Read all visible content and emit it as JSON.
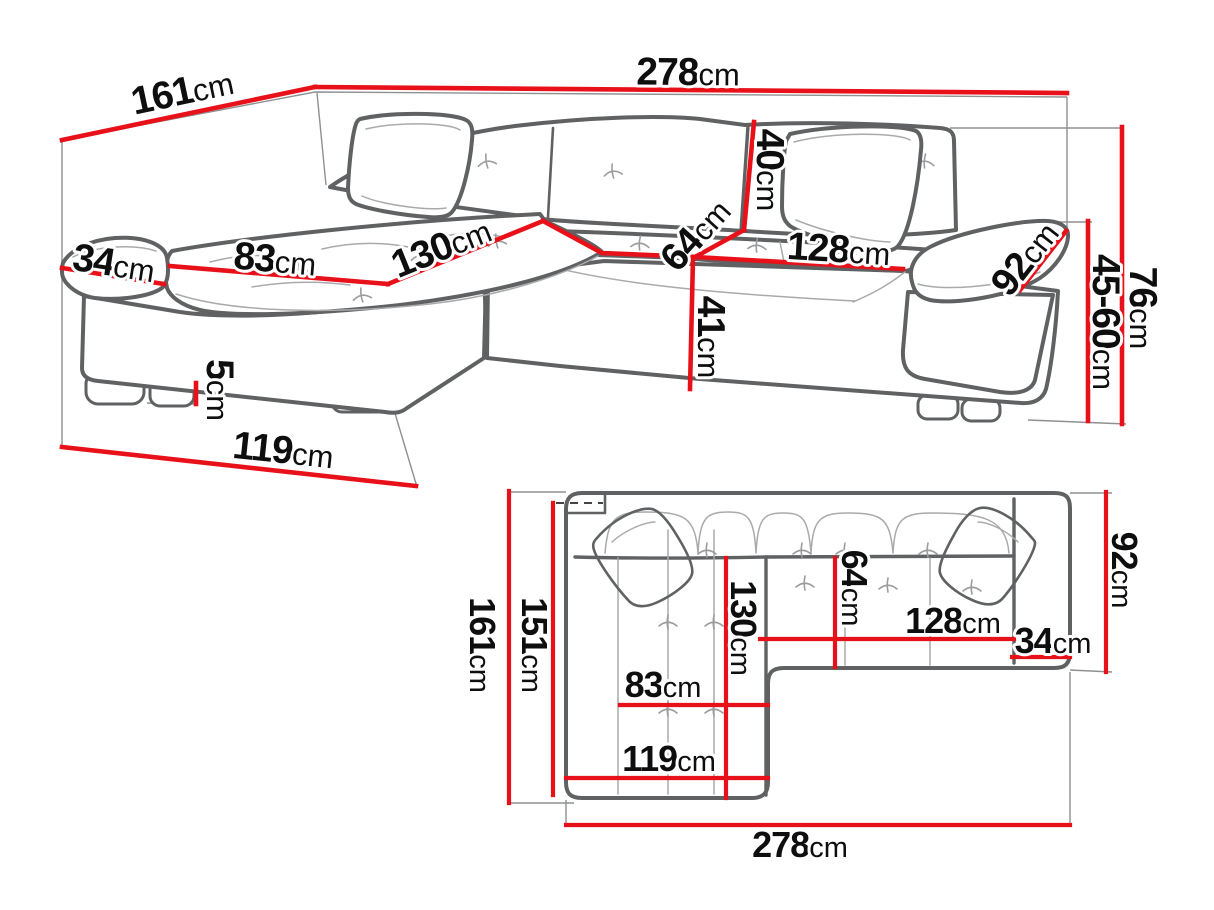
{
  "diagram": {
    "subject": "corner-sofa-dimension-drawing",
    "unit": "cm",
    "colors": {
      "dimension_line": "#e8111a",
      "sofa_outline": "#5f6163",
      "label_text": "#0e0e0e",
      "background": "#ffffff"
    },
    "views": {
      "perspective": {
        "name": "perspective-view",
        "dims": {
          "d161": {
            "value": "161",
            "unit": "cm"
          },
          "d278": {
            "value": "278",
            "unit": "cm"
          },
          "d40": {
            "value": "40",
            "unit": "cm"
          },
          "d64": {
            "value": "64",
            "unit": "cm"
          },
          "d128": {
            "value": "128",
            "unit": "cm"
          },
          "d92": {
            "value": "92",
            "unit": "cm"
          },
          "d76": {
            "value": "76",
            "unit": "cm"
          },
          "d45_60": {
            "value": "45-60",
            "unit": "cm"
          },
          "d34": {
            "value": "34",
            "unit": "cm"
          },
          "d83": {
            "value": "83",
            "unit": "cm"
          },
          "d130": {
            "value": "130",
            "unit": "cm"
          },
          "d41": {
            "value": "41",
            "unit": "cm"
          },
          "d5": {
            "value": "5",
            "unit": "cm"
          },
          "d119": {
            "value": "119",
            "unit": "cm"
          }
        }
      },
      "plan": {
        "name": "top-view",
        "dims": {
          "d161": {
            "value": "161",
            "unit": "cm"
          },
          "d151": {
            "value": "151",
            "unit": "cm"
          },
          "d130": {
            "value": "130",
            "unit": "cm"
          },
          "d64": {
            "value": "64",
            "unit": "cm"
          },
          "d128": {
            "value": "128",
            "unit": "cm"
          },
          "d34": {
            "value": "34",
            "unit": "cm"
          },
          "d92": {
            "value": "92",
            "unit": "cm"
          },
          "d83": {
            "value": "83",
            "unit": "cm"
          },
          "d119": {
            "value": "119",
            "unit": "cm"
          },
          "d278": {
            "value": "278",
            "unit": "cm"
          }
        }
      }
    }
  }
}
